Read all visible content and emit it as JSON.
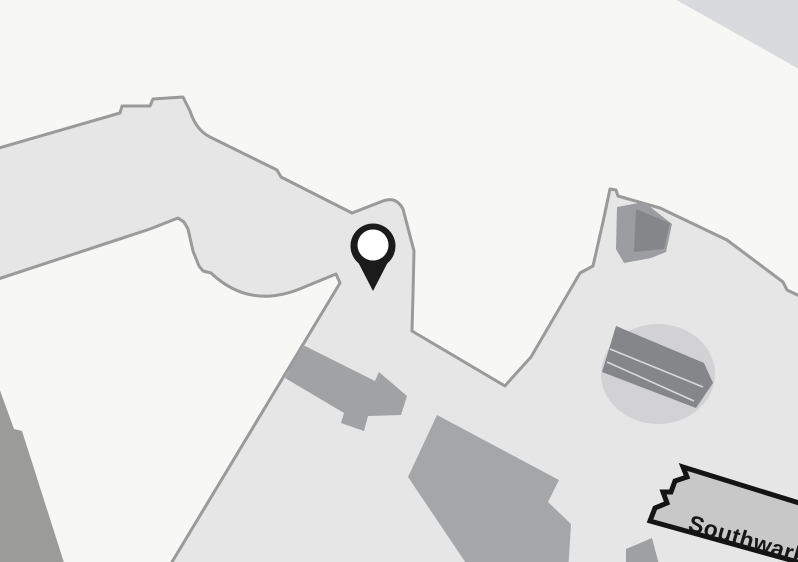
{
  "map": {
    "station_label": {
      "text": "Southwark"
    },
    "marker": {
      "transform": "translate(373,246)"
    },
    "colors": {
      "background": "#f7f7f5",
      "top_band": "#d9dadc",
      "land": "#e6e6e7",
      "boundary": "#9a9a9a",
      "building_medium": "#a5a6a8",
      "building_l": "#a1a2a4",
      "building_dark": "#85868a",
      "building_side": "#9c9da0",
      "building_round_base": "#d2d2d4",
      "building_strip": "#9fa0a2",
      "wedge": "#9b9c9a",
      "station_fill": "#c8c8c9",
      "station_outline": "#141414",
      "marker": "#1b1b1b",
      "marker_center": "#ffffff"
    }
  }
}
